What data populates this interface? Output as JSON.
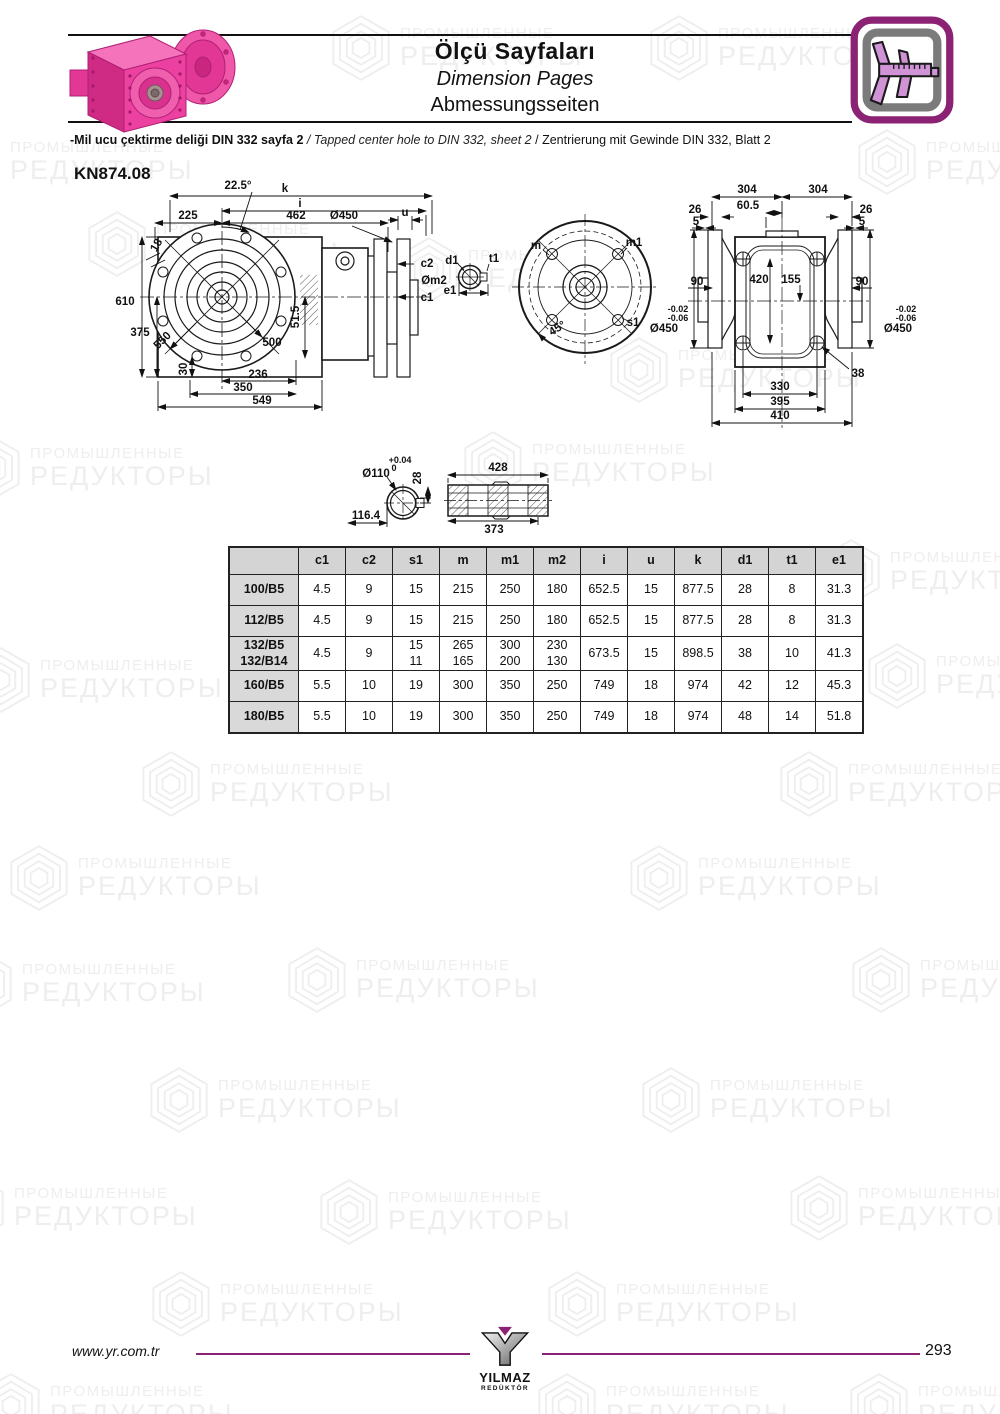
{
  "header": {
    "title_tr": "Ölçü Sayfaları",
    "title_en": "Dimension Pages",
    "title_de": "Abmessungsseiten",
    "note_tr": "-Mil ucu çektirme deliği DIN 332 sayfa 2",
    "note_sep1": "/",
    "note_en": "Tapped center hole to DIN 332, sheet 2",
    "note_sep2": "/",
    "note_de": "Zentrierung mit Gewinde DIN 332, Blatt 2"
  },
  "model": "KN874.08",
  "watermark": {
    "line1": "ПРОМЫШЛЕННЫЕ",
    "line2": "РЕДУКТОРЫ"
  },
  "drawings": {
    "side": {
      "angle": "22.5°",
      "k": "k",
      "i": "i",
      "d225": "225",
      "d462": "462",
      "dia450": "Ø450",
      "u": "u",
      "d18": "18",
      "c2": "c2",
      "m2": "Øm2",
      "c1": "c1",
      "d610": "610",
      "d375": "375",
      "d550": "550",
      "d500": "500",
      "d51_5": "51.5",
      "d30": "30",
      "d236": "236",
      "d350": "350",
      "d549": "549"
    },
    "shaft_end": {
      "d1": "d1",
      "t1": "t1",
      "e1": "e1"
    },
    "flange": {
      "m": "m",
      "m1": "m1",
      "angle45": "45°",
      "s1": "s1"
    },
    "rear": {
      "d304l": "304",
      "d304r": "304",
      "d26l": "26",
      "d26r": "26",
      "d60_5": "60.5",
      "d5l": "5",
      "d5r": "5",
      "d90l": "90",
      "d90r": "90",
      "d420": "420",
      "d155": "155",
      "tol1": "-0.02",
      "tol2": "-0.06",
      "dia450l": "Ø450",
      "dia450r": "Ø450",
      "d38": "38",
      "d330": "330",
      "d395": "395",
      "d410": "410"
    },
    "shaft": {
      "dia110": "Ø110",
      "tol_up": "+0.04",
      "tol_dn": "0",
      "d28": "28",
      "d116_4": "116.4",
      "d428": "428",
      "d373": "373"
    }
  },
  "table": {
    "headers": [
      "",
      "c1",
      "c2",
      "s1",
      "m",
      "m1",
      "m2",
      "i",
      "u",
      "k",
      "d1",
      "t1",
      "e1"
    ],
    "rows": [
      {
        "label": "100/B5",
        "values": [
          "4.5",
          "9",
          "15",
          "215",
          "250",
          "180",
          "652.5",
          "15",
          "877.5",
          "28",
          "8",
          "31.3"
        ]
      },
      {
        "label": "112/B5",
        "values": [
          "4.5",
          "9",
          "15",
          "215",
          "250",
          "180",
          "652.5",
          "15",
          "877.5",
          "28",
          "8",
          "31.3"
        ]
      },
      {
        "label": "132/B5\n132/B14",
        "values": [
          "4.5",
          "9",
          "15\n11",
          "265\n165",
          "300\n200",
          "230\n130",
          "673.5",
          "15",
          "898.5",
          "38",
          "10",
          "41.3"
        ]
      },
      {
        "label": "160/B5",
        "values": [
          "5.5",
          "10",
          "19",
          "300",
          "350",
          "250",
          "749",
          "18",
          "974",
          "42",
          "12",
          "45.3"
        ]
      },
      {
        "label": "180/B5",
        "values": [
          "5.5",
          "10",
          "19",
          "300",
          "350",
          "250",
          "749",
          "18",
          "974",
          "48",
          "14",
          "51.8"
        ]
      }
    ]
  },
  "footer": {
    "website": "www.yr.com.tr",
    "page": "293",
    "brand": "YILMAZ",
    "brand_sub": "REDÜKTÖR"
  }
}
